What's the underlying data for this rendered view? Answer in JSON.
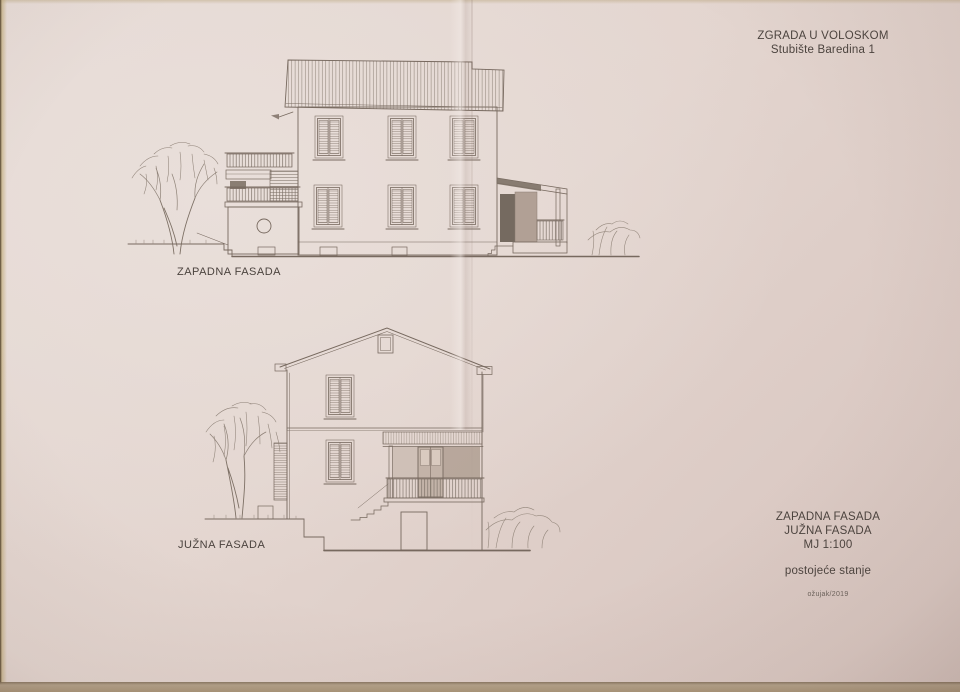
{
  "title_block": {
    "line1": "ZGRADA U VOLOSKOM",
    "line2": "Stubište Baredina 1"
  },
  "drawings": {
    "west": {
      "label": "ZAPADNA FASADA"
    },
    "south": {
      "label": "JUŽNA FASADA"
    }
  },
  "info_block": {
    "elevation1": "ZAPADNA FASADA",
    "elevation2": "JUŽNA FASADA",
    "scale": "MJ 1:100",
    "status": "postojeće stanje",
    "date": "ožujak/2019"
  },
  "colors": {
    "paper": "#e4d6d0",
    "pencil": "#77695f",
    "text_ink": "#4b433e",
    "table_surface": "#b2a088",
    "porch_shade_dark": "#756a60",
    "porch_shade_mid": "#b1a095"
  }
}
